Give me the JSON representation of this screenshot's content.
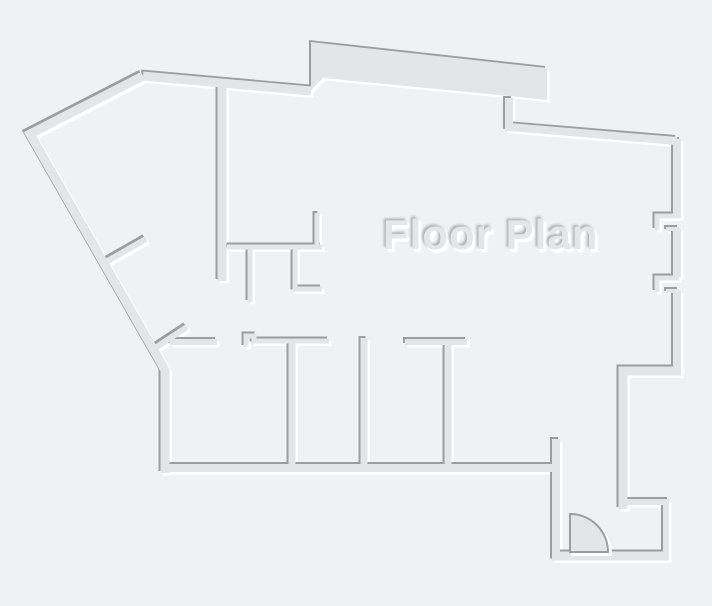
{
  "title": "Floor Plan",
  "colors": {
    "background": "#f0f1f2",
    "wall_fill": "#e3e5e6",
    "wall_shadow_dark": "#9b9da0",
    "wall_highlight": "#ffffff",
    "title_fill": "#e4e6e7"
  },
  "floorplan": {
    "emboss": {
      "dark_offset": [
        -2,
        -2
      ],
      "light_offset": [
        2.5,
        2.5
      ]
    },
    "filled_shapes": [
      {
        "name": "thick-top-wall-slab",
        "points": "311,42 547,68 547,100 509,96 323,78 311,90"
      }
    ],
    "walls": [
      {
        "name": "outer-west-diagonal-and-left-wall",
        "d": "M143,76 L30,134 L165,370 L165,473",
        "w": 9
      },
      {
        "name": "outer-top-wall",
        "d": "M143,76 L311,91",
        "w": 9
      },
      {
        "name": "hall-vertical-wall",
        "d": "M222,85 L222,281",
        "w": 9
      },
      {
        "name": "top-right-sloped-wall",
        "d": "M509,98 L509,127 L677,141",
        "w": 8
      },
      {
        "name": "right-outer-wall-upper",
        "d": "M677,139 L677,218",
        "w": 8
      },
      {
        "name": "right-outer-wall-middle",
        "d": "M677,229 L677,277",
        "w": 8
      },
      {
        "name": "right-outer-wall-lower",
        "d": "M677,291 L677,372",
        "w": 8
      },
      {
        "name": "window-return-1",
        "d": "M679,216 L657,216 L657,230",
        "w": 5
      },
      {
        "name": "window-sill-1",
        "d": "M666,229 L679,229",
        "w": 4
      },
      {
        "name": "window-return-2",
        "d": "M679,278 L657,278 L657,292",
        "w": 5
      },
      {
        "name": "window-sill-2",
        "d": "M666,291 L679,291",
        "w": 4
      },
      {
        "name": "right-step-wall",
        "d": "M681,371 L623,371 L623,509",
        "w": 9
      },
      {
        "name": "bottom-right-room-wall",
        "d": "M620,502 L666,502 L666,556",
        "w": 6
      },
      {
        "name": "bottom-exterior-wall",
        "d": "M552,556 L669,556",
        "w": 9
      },
      {
        "name": "corridor-left-wall",
        "d": "M556,439 L556,557",
        "w": 8
      },
      {
        "name": "rooms-bottom-wall",
        "d": "M161,468 L554,468",
        "w": 8
      },
      {
        "name": "room1-top-wall",
        "d": "M170,342 L217,342",
        "w": 6
      },
      {
        "name": "room2-top-wall-with-jog",
        "d": "M246,347 L246,336 L254,336 L254,341 L329,341",
        "w": 5
      },
      {
        "name": "divider-room1-room2",
        "d": "M292,339 L292,467",
        "w": 7
      },
      {
        "name": "divider-room2-room3",
        "d": "M364,338 L364,467",
        "w": 7
      },
      {
        "name": "room3-top-wall",
        "d": "M405,342 L467,342",
        "w": 6
      },
      {
        "name": "divider-room3-room4",
        "d": "M448,343 L448,467",
        "w": 7
      },
      {
        "name": "diagonal-spur-upper",
        "d": "M104,263 L146,239",
        "w": 6
      },
      {
        "name": "diagonal-spur-lower",
        "d": "M155,348 L187,327",
        "w": 6
      },
      {
        "name": "closet-top-wall",
        "d": "M227,247 L322,247",
        "w": 5
      },
      {
        "name": "closet-up-stub",
        "d": "M317,213 L317,247",
        "w": 5
      },
      {
        "name": "closet-down-stub-left",
        "d": "M250,247 L250,302",
        "w": 5
      },
      {
        "name": "closet-l-wall",
        "d": "M295,247 L295,289 L322,289",
        "w": 5
      }
    ],
    "door": {
      "name": "entry-door-swing",
      "d": "M570,552 L570,514 A38,38 0 0 1 608,552 Z",
      "leaf_stroke_w": 2,
      "shadow_stroke_w": 3
    }
  }
}
